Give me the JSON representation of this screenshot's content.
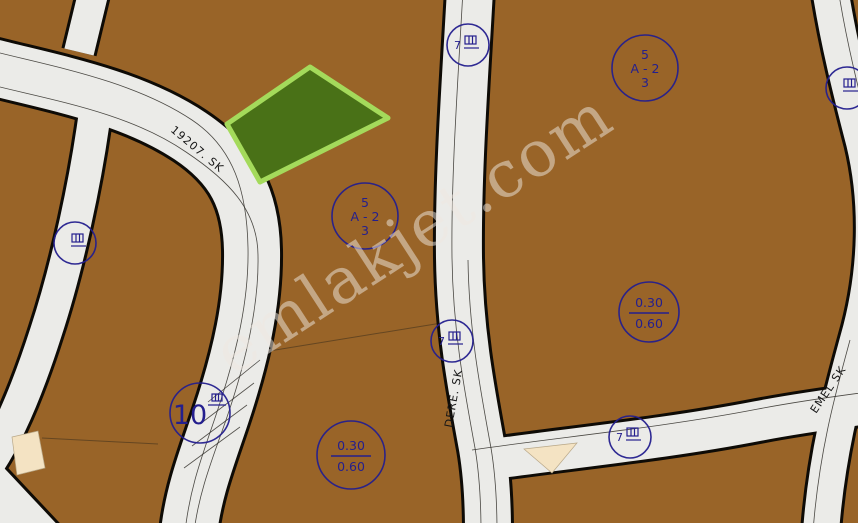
{
  "watermark": "emlakjet.com",
  "colors": {
    "parcel-brown": "#996428",
    "road-fill": "#ebebe8",
    "road-border": "#0e0b06",
    "annotation-blue": "#241f8e",
    "parcel-green-fill": "#497117",
    "parcel-green-border": "#a4da5b",
    "parcel-beige": "#f4e3c3",
    "watermark-color": "#efe9e2"
  },
  "streets": [
    {
      "name": "19207. SK"
    },
    {
      "name": "DERE. SK"
    },
    {
      "name": "EMEL SK"
    }
  ],
  "annotations": {
    "zone_circles": [
      {
        "lines": [
          "5",
          "A - 2",
          "3"
        ]
      },
      {
        "lines": [
          "5",
          "A - 2",
          "3"
        ]
      }
    ],
    "ratio_circles": [
      {
        "num": "0.30",
        "den": "0.60"
      },
      {
        "num": "0.30",
        "den": "0.60"
      }
    ],
    "parcel_number_circle": {
      "value": "10"
    },
    "utility_markers": [
      {
        "label": "7"
      },
      {
        "label": ""
      },
      {
        "label": "7"
      },
      {
        "label": "7"
      },
      {
        "label": ""
      }
    ]
  }
}
